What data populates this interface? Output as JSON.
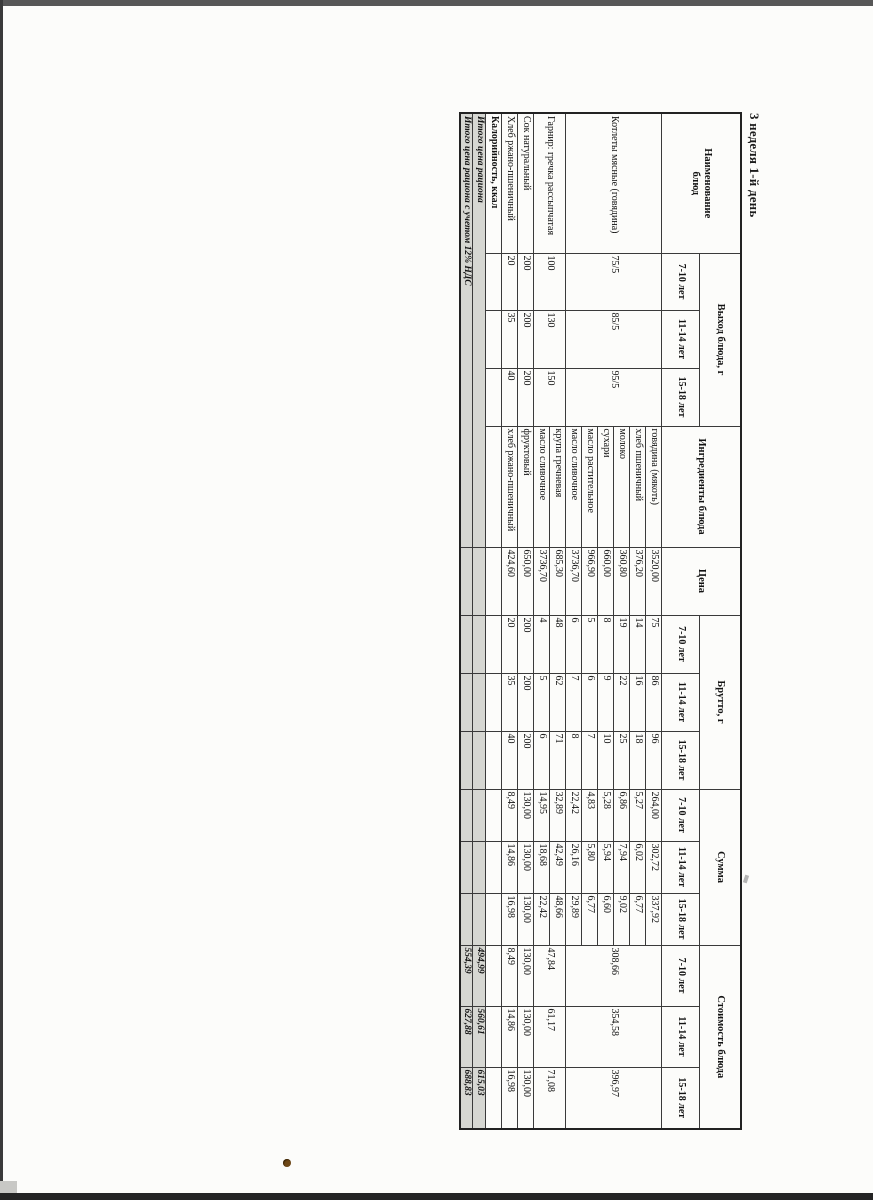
{
  "page": {
    "title": "3 неделя 1-й день"
  },
  "colors": {
    "paper": "#fcfcfa",
    "table_border": "#3a3a3a",
    "total_row_shading": "#d6d7d2",
    "scan_edge_top": "#575757",
    "scan_edge_bottom": "#242424"
  },
  "table": {
    "headers": {
      "name": "Наименование блюд",
      "yield": "Выход блюда, г",
      "ingredients": "Ингредиенты блюда",
      "price": "Цена",
      "gross": "Брутто, г",
      "sum": "Сумма",
      "cost": "Стоимость блюда",
      "ages": [
        "7-10 лет",
        "11-14 лет",
        "15-18 лет"
      ]
    },
    "dishes": {
      "kotlety": {
        "name": "Котлеты мясные (говядина)",
        "yield": [
          "75/5",
          "85/5",
          "95/5"
        ],
        "cost": [
          "308,66",
          "354,58",
          "396,97"
        ],
        "rows": [
          {
            "ingredient": "говядина (мякоть)",
            "price": "3520,00",
            "gross": [
              "75",
              "86",
              "96"
            ],
            "sum": [
              "264,00",
              "302,72",
              "337,92"
            ]
          },
          {
            "ingredient": "хлеб пшеничный",
            "price": "376,20",
            "gross": [
              "14",
              "16",
              "18"
            ],
            "sum": [
              "5,27",
              "6,02",
              "6,77"
            ]
          },
          {
            "ingredient": "молоко",
            "price": "360,80",
            "gross": [
              "19",
              "22",
              "25"
            ],
            "sum": [
              "6,86",
              "7,94",
              "9,02"
            ]
          },
          {
            "ingredient": "сухари",
            "price": "660,00",
            "gross": [
              "8",
              "9",
              "10"
            ],
            "sum": [
              "5,28",
              "5,94",
              "6,60"
            ]
          },
          {
            "ingredient": "масло растительное",
            "price": "966,90",
            "gross": [
              "5",
              "6",
              "7"
            ],
            "sum": [
              "4,83",
              "5,80",
              "6,77"
            ]
          },
          {
            "ingredient": "масло сливочное",
            "price": "3736,70",
            "gross": [
              "6",
              "7",
              "8"
            ],
            "sum": [
              "22,42",
              "26,16",
              "29,89"
            ]
          }
        ]
      },
      "garnir": {
        "name": "Гарнир: гречка рассыпчатая",
        "yield": [
          "100",
          "130",
          "150"
        ],
        "cost": [
          "47,84",
          "61,17",
          "71,08"
        ],
        "rows": [
          {
            "ingredient": "крупа гречневая",
            "price": "685,30",
            "gross": [
              "48",
              "62",
              "71"
            ],
            "sum": [
              "32,89",
              "42,49",
              "48,66"
            ]
          },
          {
            "ingredient": "масло сливочное",
            "price": "3736,70",
            "gross": [
              "4",
              "5",
              "6"
            ],
            "sum": [
              "14,95",
              "18,68",
              "22,42"
            ]
          }
        ]
      },
      "sok": {
        "name": "Сок натуральный",
        "yield": [
          "200",
          "200",
          "200"
        ],
        "cost": [
          "130,00",
          "130,00",
          "130,00"
        ],
        "rows": [
          {
            "ingredient": "фруктовый",
            "price": "650,00",
            "gross": [
              "200",
              "200",
              "200"
            ],
            "sum": [
              "130,00",
              "130,00",
              "130,00"
            ]
          }
        ]
      },
      "hleb": {
        "name": "Хлеб ржано-пшеничный",
        "yield": [
          "20",
          "35",
          "40"
        ],
        "cost": [
          "8,49",
          "14,86",
          "16,98"
        ],
        "rows": [
          {
            "ingredient": "хлеб ржано-пшеничный",
            "price": "424,60",
            "gross": [
              "20",
              "35",
              "40"
            ],
            "sum": [
              "8,49",
              "14,86",
              "16,98"
            ]
          }
        ]
      }
    },
    "calories_row": {
      "label": "Калорийность, ккал"
    },
    "totals": [
      {
        "label": "Итого цена рациона",
        "values": [
          "494,99",
          "560,61",
          "615,03"
        ]
      },
      {
        "label": "Итого цена рациона с учетом 12% НДС",
        "values": [
          "554,39",
          "627,88",
          "688,83"
        ]
      }
    ]
  }
}
